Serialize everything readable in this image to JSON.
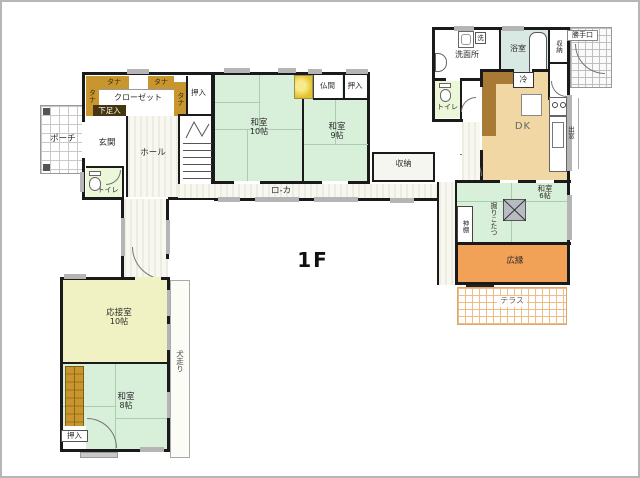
{
  "title": "1F house floor plan",
  "floor_label": "1F",
  "labels": {
    "floor": "1F",
    "porch": "ポーチ",
    "genkan": "玄関",
    "gesokuire": "下足入",
    "tana": "タナ",
    "closet": "クローゼット",
    "oshiire": "押入",
    "hall": "ホール",
    "toilet": "トイレ",
    "up": "UP",
    "washitsu": "和室",
    "mats10": "10帖",
    "mats9": "9帖",
    "mats8": "8帖",
    "mats6": "6帖",
    "butsuma": "仏間",
    "roka": "ロ-カ",
    "shuno": "収納",
    "senmenjo": "洗面所",
    "sentaku": "洗",
    "yokushitsu": "浴室",
    "katteguchi": "勝手口",
    "rei": "冷",
    "dk": "DK",
    "demado": "出窓",
    "kamidana": "神棚",
    "horigotatsu": "掘りこたつ",
    "hiroen": "広縁",
    "terasu": "テラス",
    "ousetsushitsu": "応接室",
    "inubashiri": "犬走り"
  },
  "colors": {
    "wall": "#1a1a1a",
    "tatami_green": "#d8efda",
    "tatami_line": "#a9ceae",
    "reception_yellow": "#f0f2c4",
    "dk_tan": "#f1d7a4",
    "counter_brown": "#a97a35",
    "hiroen_orange": "#f2a257",
    "tana_gold": "#c9952e",
    "gesoku_dark": "#453510",
    "bath_teal": "#d8e9e3",
    "toilet_green": "#ecf6d9",
    "tokonoma_gold": "#e6c22a",
    "window_gray": "#b5b5b5",
    "terrace_grid": "#f0bc85",
    "frame_gray": "#b6b6b6"
  }
}
